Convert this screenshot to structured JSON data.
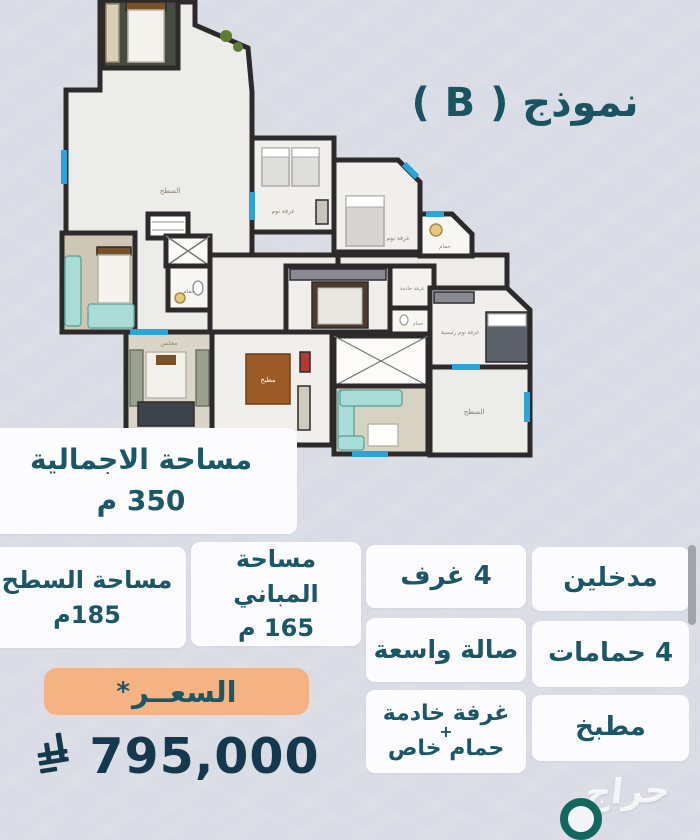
{
  "colors": {
    "accent_teal": "#1a5866",
    "price_navy": "#14384d",
    "price_badge_orange": "#f5b283",
    "wall_dark": "#2d2a2c",
    "furniture_teal": "#a9dcd6",
    "window_blue": "#2ba4da"
  },
  "title": "نموذج ( B )",
  "floor_plan": {
    "labels": {
      "roof_top": "السطح",
      "roof_right": "السطح",
      "bedroom_a": "غرفة نوم",
      "bedroom_b": "غرفة نوم",
      "master_bedroom": "غرفة نوم رئيسية",
      "bath_a": "حمام",
      "bath_b": "حمام",
      "bath_maid": "حمام",
      "majlis": "مجلس",
      "kitchen": "مطبخ",
      "maid_room": "غرفة خادمة"
    }
  },
  "specs": {
    "total_area": {
      "label": "مساحة الاجمالية",
      "value": "350 م"
    },
    "roof_area": {
      "label": "مساحة السطح",
      "value": "185م"
    },
    "building_area": {
      "label": "مساحة المباني",
      "value": "165 م"
    },
    "rooms": "4 غرف",
    "entrances": "مدخلين",
    "hall": "صالة واسعة",
    "bathrooms": "4 حمامات",
    "maid_room": {
      "line1": "غرفة خادمة",
      "plus": "+",
      "line2": "حمام خاص"
    },
    "kitchen": "مطبخ"
  },
  "price": {
    "label": "السعــر",
    "asterisk": "*",
    "value": "795,000",
    "currency_icon": "saudi-riyal-symbol"
  },
  "watermark": "حراج"
}
